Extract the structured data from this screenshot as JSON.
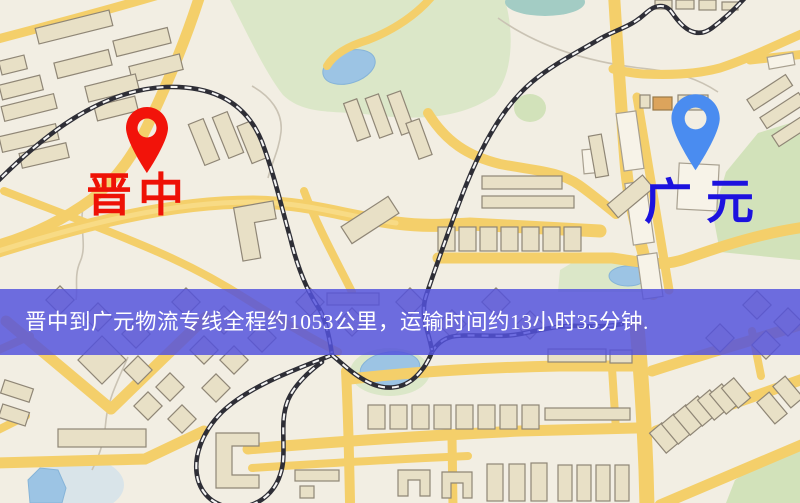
{
  "type": "static-route-map",
  "markers": {
    "origin": {
      "label": "晋中",
      "pin_color": "#f2130a",
      "label_color": "#ee1206"
    },
    "destination": {
      "label": "广元",
      "pin_color": "#4a8cf0",
      "label_color": "#1c12de"
    }
  },
  "banner": {
    "text": "晋中到广元物流专线全程约1053公里，运输时间约13小时35分钟.",
    "background_color": "#5352dc",
    "text_color": "#ffffff"
  },
  "map_colors": {
    "background": "#f2eee3",
    "road": "#f4cf6a",
    "railway": "#2e2e36",
    "park": "#dbe7c8",
    "water": "#9cc4e4",
    "building": "#e8e0c6"
  }
}
